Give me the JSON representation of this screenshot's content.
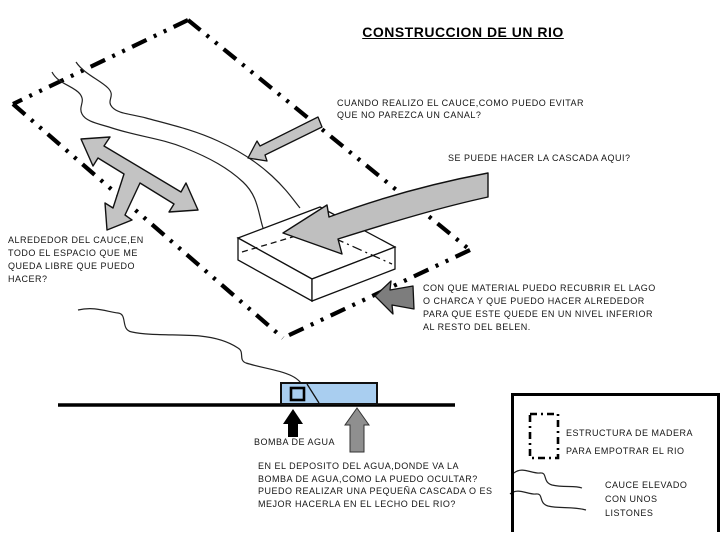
{
  "title": "CONSTRUCCION DE UN RIO",
  "questions": {
    "canal": "CUANDO REALIZO EL CAUCE,COMO PUEDO EVITAR\nQUE NO PAREZCA UN CANAL?",
    "cascada": "SE PUEDE HACER  LA CASCADA AQUI?",
    "alrededor": "ALREDEDOR DEL CAUCE,EN\nTODO EL ESPACIO QUE ME\nQUEDA LIBRE QUE PUEDO\nHACER?",
    "material": "CON QUE MATERIAL PUEDO RECUBRIR EL LAGO\nO CHARCA Y QUE PUEDO HACER ALREDEDOR\nPARA QUE ESTE QUEDE EN UN NIVEL INFERIOR\nAL RESTO DEL BELEN.",
    "deposito": "EN EL DEPOSITO DEL AGUA,DONDE VA LA\nBOMBA DE AGUA,COMO LA PUEDO OCULTAR?\nPUEDO REALIZAR UNA PEQUEÑA CASCADA O ES\nMEJOR HACERLA EN EL LECHO DEL RIO?"
  },
  "labels": {
    "bomba": "BOMBA DE AGUA"
  },
  "legend": {
    "estructura": "ESTRUCTURA DE MADERA\nPARA EMPOTRAR EL RIO",
    "cauce": "CAUCE ELEVADO\nCON UNOS\nLISTONES"
  },
  "icons": {
    "triple_arrow": "three-way-arrow",
    "canal_arrow": "diagonal-arrow",
    "cascade_arrow": "curved-arrow",
    "material_arrow": "left-block-arrow",
    "pump_arrow": "up-arrow-black",
    "deposit_arrow": "up-arrow-gray"
  },
  "colors": {
    "arrow_light_gray": "#c3c3c3",
    "arrow_dark_gray": "#7d7d7d",
    "arrow_medium_gray": "#8f8f8f",
    "water_blue": "#a9cef0",
    "ink": "#000000"
  }
}
